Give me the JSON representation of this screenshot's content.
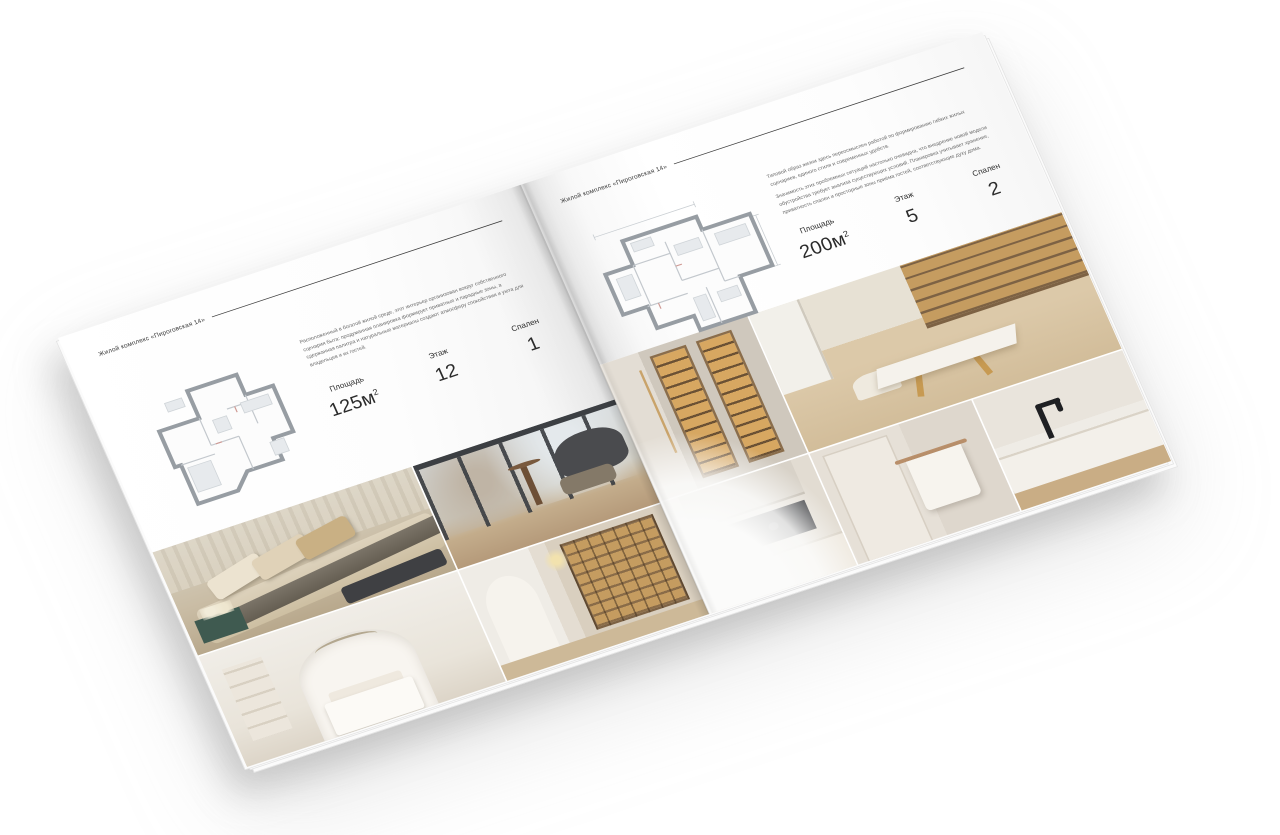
{
  "background": "#ffffff",
  "brochure": {
    "project_name": "Жилой комплекс «Пироговская 14»",
    "left_page": {
      "header": "Жилой комплекс «Пироговская 14»",
      "description": "Расположенный в богатой жилой среде, этот интерьер организован вокруг собственного сценария быта: продуманная планировка формирует приватные и парадные зоны, а сдержанная палитра и натуральные материалы создают атмосферу спокойствия и уюта для владельцев и их гостей.",
      "specs": {
        "area_label": "Площадь",
        "area_value": "125м",
        "area_sup": "2",
        "floor_label": "Этаж",
        "floor_value": "12",
        "bedrooms_label": "Спален",
        "bedrooms_value": "1"
      },
      "photos": [
        "bedroom",
        "living-room-panorama",
        "white-bedroom-arch",
        "hallway-library"
      ]
    },
    "right_page": {
      "header": "Жилой комплекс «Пироговская 14»",
      "description_1": "Типовой образ жизни здесь переосмыслен работой по формированию гибких жилых сценариев, единого стиля и современных удобств.",
      "description_2": "Значимость этих проблемных ситуаций настолько очевидна, что внедрение новой модели обустройства требует анализа существующих условий. Планировка учитывает хранение, приватность спален и просторные зоны приёма гостей, соответствующие духу дома.",
      "specs": {
        "area_label": "Площадь",
        "area_value": "200м",
        "area_sup": "2",
        "floor_label": "Этаж",
        "floor_value": "5",
        "bedrooms_label": "Спален",
        "bedrooms_value": "2"
      },
      "photos": [
        "wardrobe-lit-shelves",
        "study-office",
        "kitchen-cooktop",
        "bathroom-towel",
        "washbasin-black-tap"
      ]
    }
  }
}
